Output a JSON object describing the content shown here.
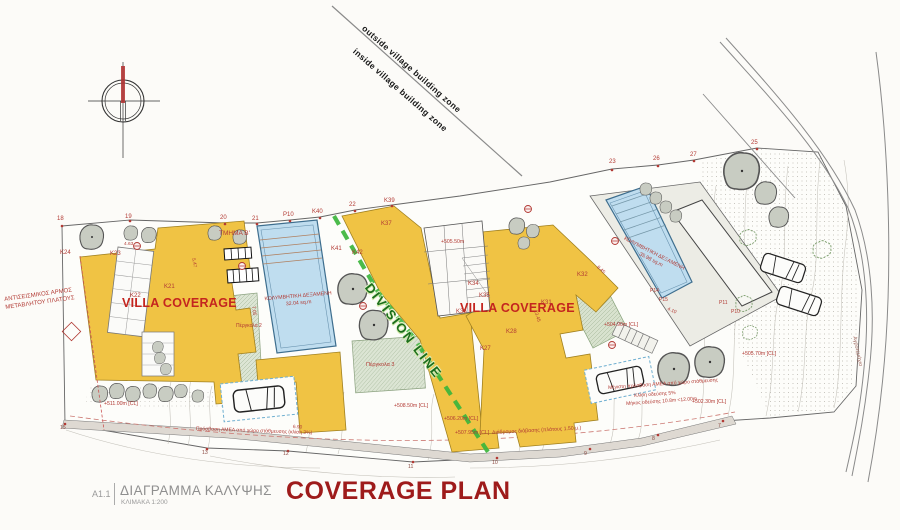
{
  "title_block": {
    "sheet": "A1.1",
    "title_el": "ΔΙΑΓΡΑΜΜΑ ΚΑΛΥΨΗΣ",
    "scale": "ΚΛΙΜΑΚΑ 1:200",
    "title_en": "COVERAGE PLAN"
  },
  "zone": {
    "outside": "outside village building zone",
    "inside": "inside village building zone"
  },
  "division": {
    "label": "DIVISION LINE"
  },
  "villas": {
    "left": "VILLA COVERAGE",
    "right": "VILLA COVERAGE"
  },
  "pools": {
    "left": {
      "name": "ΚΟΛΥΜΒΗΤΙΚΗ ΔΕΞΑΜΕΝΗ",
      "area": "32.04 sq.m"
    },
    "right": {
      "name": "ΚΟΛΥΜΒΗΤΙΚΗ ΔΕΞΑΜΕΝΗ",
      "area": "35.98 sq.m"
    }
  },
  "notes": {
    "seismic_1": "ΑΝΤΙΣΕΙΣΜΙΚΟΣ ΑΡΜΟΣ",
    "seismic_2": "ΜΕΤΑΒΛΗΤΟΥ ΠΛΑΤΟΥΣ"
  },
  "colors": {
    "villa_fill": "#F0C344",
    "pool_fill": "#BFDDEF",
    "division_green": "#3CB53C",
    "annotation_red": "#B23A34",
    "title_red": "#9E1B1B"
  },
  "scatter_labels": [
    {
      "t": "18",
      "x": 57,
      "y": 216
    },
    {
      "t": "19",
      "x": 125,
      "y": 214
    },
    {
      "t": "20",
      "x": 220,
      "y": 215
    },
    {
      "t": "21",
      "x": 252,
      "y": 216
    },
    {
      "t": "P10",
      "x": 283,
      "y": 212
    },
    {
      "t": "K40",
      "x": 312,
      "y": 209
    },
    {
      "t": "22",
      "x": 349,
      "y": 202
    },
    {
      "t": "K39",
      "x": 384,
      "y": 198
    },
    {
      "t": "23",
      "x": 609,
      "y": 159
    },
    {
      "t": "26",
      "x": 653,
      "y": 156
    },
    {
      "t": "27",
      "x": 690,
      "y": 152
    },
    {
      "t": "25",
      "x": 751,
      "y": 140
    },
    {
      "t": "K37",
      "x": 381,
      "y": 221
    },
    {
      "t": "K41",
      "x": 331,
      "y": 246
    },
    {
      "t": "K42",
      "x": 352,
      "y": 250
    },
    {
      "t": "K24",
      "x": 60,
      "y": 250
    },
    {
      "t": "K23",
      "x": 110,
      "y": 251
    },
    {
      "t": "K22",
      "x": 130,
      "y": 293
    },
    {
      "t": "K21",
      "x": 164,
      "y": 284
    },
    {
      "t": "K34",
      "x": 468,
      "y": 281
    },
    {
      "t": "K35",
      "x": 479,
      "y": 293
    },
    {
      "t": "K36",
      "x": 456,
      "y": 309
    },
    {
      "t": "K32",
      "x": 577,
      "y": 272
    },
    {
      "t": "K31",
      "x": 541,
      "y": 300
    },
    {
      "t": "K28",
      "x": 506,
      "y": 329
    },
    {
      "t": "K27",
      "x": 480,
      "y": 346
    },
    {
      "t": "P14",
      "x": 650,
      "y": 289,
      "s": 5
    },
    {
      "t": "P15",
      "x": 659,
      "y": 298,
      "s": 5
    },
    {
      "t": "P11",
      "x": 719,
      "y": 301,
      "s": 5
    },
    {
      "t": "P10",
      "x": 731,
      "y": 310,
      "s": 5
    },
    {
      "t": "ΤΜΗΜΑ Β'",
      "x": 219,
      "y": 231,
      "s": 6.5
    },
    {
      "t": "+505.50m",
      "x": 441,
      "y": 240,
      "s": 5.2
    },
    {
      "t": "+504.90m [CL]",
      "x": 604,
      "y": 323,
      "s": 5.2
    },
    {
      "t": "+511.00m [CL]",
      "x": 104,
      "y": 402,
      "s": 5.2
    },
    {
      "t": "+508.50m [CL]",
      "x": 394,
      "y": 404,
      "s": 5.2
    },
    {
      "t": "+506.20m [CL]",
      "x": 444,
      "y": 417,
      "s": 5.2
    },
    {
      "t": "+507.95m [CL]",
      "x": 455,
      "y": 431,
      "s": 5.2
    },
    {
      "t": "+505.70m [CL]",
      "x": 742,
      "y": 352,
      "s": 5.2
    },
    {
      "t": "+502.30m [CL]",
      "x": 692,
      "y": 400,
      "s": 5.2
    },
    {
      "t": "Διάδρομος διάβασης (πλάτους 1.50 μ.)",
      "x": 492,
      "y": 431,
      "s": 5.2,
      "r": -3
    },
    {
      "t": "Μέγιστη πρόσβαση ΑΜΕΑ από χώρο στάθμευσης",
      "x": 608,
      "y": 386,
      "s": 5,
      "r": -4
    },
    {
      "t": "Κλίση οδεύσης 5%",
      "x": 634,
      "y": 394,
      "s": 5,
      "r": -4
    },
    {
      "t": "Μήκος οδεύσης 10.8m &lt;12.00m",
      "x": 626,
      "y": 402,
      "s": 5,
      "r": -4
    },
    {
      "t": "Πρόσβαση ΑΜΕΑ από χώρο στάθμευσης (κλίση 3%)",
      "x": 196,
      "y": 427,
      "s": 5,
      "r": 2
    },
    {
      "t": "Πέργκολα 2",
      "x": 236,
      "y": 324,
      "s": 5
    },
    {
      "t": "Πέργκολα 3",
      "x": 366,
      "y": 363,
      "s": 5.5
    },
    {
      "t": "Αγροτεμάχιο",
      "x": 856,
      "y": 336,
      "r": 78,
      "s": 5.5,
      "c": "#A06A60"
    },
    {
      "t": "4.63",
      "x": 124,
      "y": 243,
      "s": 4.8
    },
    {
      "t": "5.47",
      "x": 194,
      "y": 258,
      "r": 78,
      "s": 4.8
    },
    {
      "t": "7.05",
      "x": 254,
      "y": 306,
      "r": 82,
      "s": 4.8
    },
    {
      "t": "13.45",
      "x": 536,
      "y": 310,
      "r": 72,
      "s": 4.8
    },
    {
      "t": "8.45",
      "x": 598,
      "y": 266,
      "r": 42,
      "s": 4.8
    },
    {
      "t": "4.10",
      "x": 668,
      "y": 308,
      "r": 24,
      "s": 4.8
    },
    {
      "t": "6.90",
      "x": 293,
      "y": 426,
      "r": 3,
      "s": 4.8
    },
    {
      "t": "15",
      "x": 60,
      "y": 426,
      "c": "#8B4A42",
      "s": 5.2
    },
    {
      "t": "13",
      "x": 202,
      "y": 451,
      "c": "#8B4A42",
      "s": 5.2
    },
    {
      "t": "12",
      "x": 283,
      "y": 452,
      "c": "#8B4A42",
      "s": 5.2
    },
    {
      "t": "11",
      "x": 408,
      "y": 465,
      "c": "#8B4A42",
      "s": 5.2
    },
    {
      "t": "10",
      "x": 492,
      "y": 461,
      "c": "#8B4A42",
      "s": 5.2
    },
    {
      "t": "9",
      "x": 584,
      "y": 452,
      "c": "#8B4A42",
      "s": 5.2
    },
    {
      "t": "8",
      "x": 652,
      "y": 437,
      "c": "#8B4A42",
      "s": 5.2
    },
    {
      "t": "7",
      "x": 718,
      "y": 424,
      "c": "#8B4A42",
      "s": 5.2
    }
  ]
}
